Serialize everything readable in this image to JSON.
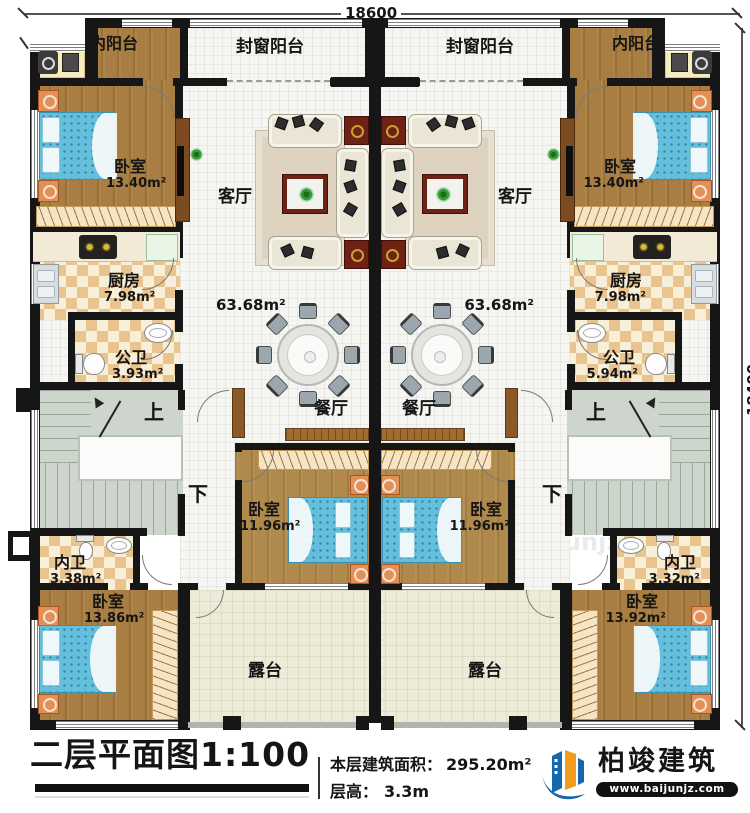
{
  "dimensions": {
    "top": "18600",
    "right": "18400"
  },
  "plan": {
    "left": {
      "inner_balcony": "内阳台",
      "sealed_balcony": "封窗阳台",
      "bedroom_top": "卧室",
      "bedroom_top_area": "13.40m²",
      "living": "客厅",
      "living_area": "63.68m²",
      "kitchen": "厨房",
      "kitchen_area": "7.98m²",
      "public_bath": "公卫",
      "public_bath_area": "3.93m²",
      "dining": "餐厅",
      "bedroom_mid": "卧室",
      "bedroom_mid_area": "11.96m²",
      "inner_bath": "内卫",
      "inner_bath_area": "3.38m²",
      "bedroom_bottom": "卧室",
      "bedroom_bottom_area": "13.86m²",
      "terrace": "露台",
      "up": "上",
      "down": "下"
    },
    "right": {
      "inner_balcony": "内阳台",
      "sealed_balcony": "封窗阳台",
      "bedroom_top": "卧室",
      "bedroom_top_area": "13.40m²",
      "living": "客厅",
      "living_area": "63.68m²",
      "kitchen": "厨房",
      "kitchen_area": "7.98m²",
      "public_bath": "公卫",
      "public_bath_area": "5.94m²",
      "dining": "餐厅",
      "bedroom_mid": "卧室",
      "bedroom_mid_area": "11.96m²",
      "inner_bath": "内卫",
      "inner_bath_area": "3.32m²",
      "bedroom_bottom": "卧室",
      "bedroom_bottom_area": "13.92m²",
      "terrace": "露台",
      "up": "上",
      "down": "下"
    }
  },
  "title_block": {
    "title": "二层平面图1:100",
    "area_label": "本层建筑面积：",
    "area_value": "295.20m²",
    "height_label": "层高：",
    "height_value": "3.3m"
  },
  "logo": {
    "name": "柏竣建筑",
    "url": "www.baijunjz.com"
  },
  "watermark": {
    "brand": "柏竣建筑",
    "url": "www.baijunjz.com"
  },
  "colors": {
    "wall": "#161616",
    "wood_floor": "#a97e42",
    "tile_checker": "#e9c48e",
    "bed_blue": "#64bfdc",
    "stair_green": "#cdd5cc",
    "terrace_floor": "#edecd9",
    "table_maroon": "#6e2115",
    "logo_blue": "#1566ab",
    "logo_orange": "#f29b1d"
  }
}
